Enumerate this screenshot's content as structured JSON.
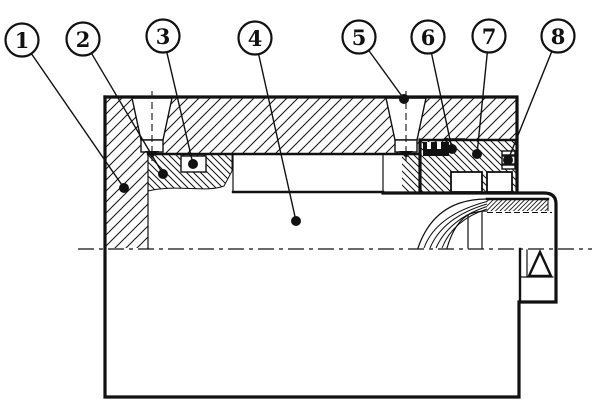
{
  "drawing": {
    "title": "pulley-end-assembly-section",
    "colors": {
      "line": "#111111",
      "background": "#ffffff"
    },
    "callout_style": {
      "radius": 16.5,
      "ring_width": 2.2,
      "leader_width": 1.4,
      "dot_radius": 5,
      "font_size": 21
    },
    "callouts": [
      {
        "label": "1",
        "cx": 22,
        "cy": 40,
        "dx": 124,
        "dy": 188
      },
      {
        "label": "2",
        "cx": 83,
        "cy": 39,
        "dx": 163,
        "dy": 174
      },
      {
        "label": "3",
        "cx": 163,
        "cy": 36,
        "dx": 193,
        "dy": 164
      },
      {
        "label": "4",
        "cx": 255,
        "cy": 38,
        "dx": 296,
        "dy": 221
      },
      {
        "label": "5",
        "cx": 359,
        "cy": 37,
        "dx": 404,
        "dy": 99
      },
      {
        "label": "6",
        "cx": 428,
        "cy": 37,
        "dx": 452,
        "dy": 149
      },
      {
        "label": "7",
        "cx": 489,
        "cy": 36,
        "dx": 477,
        "dy": 154
      },
      {
        "label": "8",
        "cx": 558,
        "cy": 36,
        "dx": 508,
        "dy": 160
      }
    ]
  }
}
